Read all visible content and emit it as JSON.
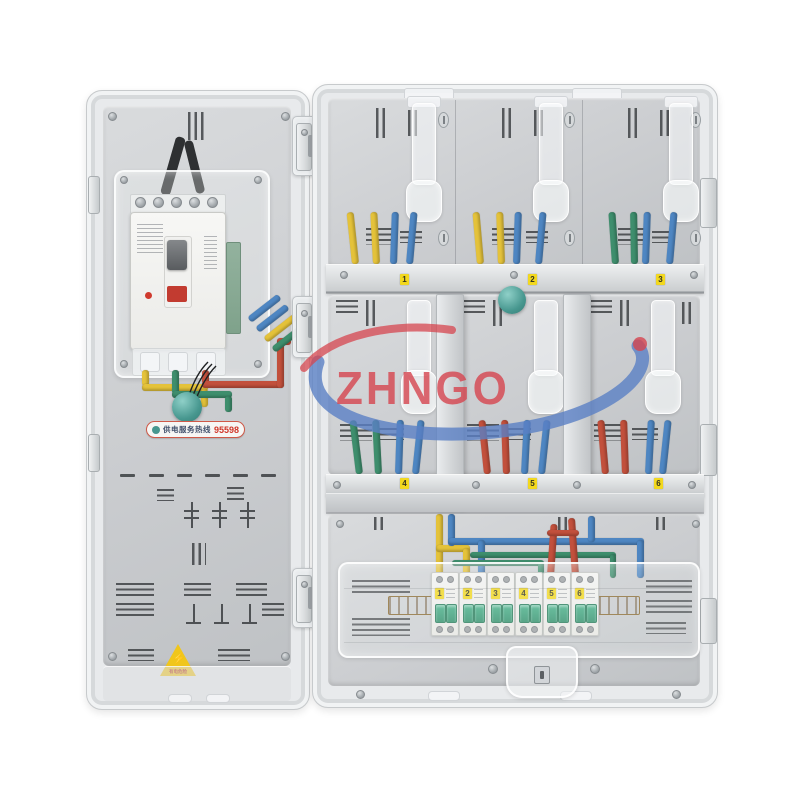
{
  "watermark": {
    "text": "ZHNGO"
  },
  "left_panel": {
    "hotline_label": {
      "prefix": "供电服务热线",
      "number": "95598"
    },
    "warning_sticker": {
      "bolt": "⚡",
      "text": "有电危险"
    }
  },
  "meter_rows": {
    "top_tags": [
      "1",
      "2",
      "3"
    ],
    "mid_tags": [
      "4",
      "5",
      "6"
    ]
  },
  "breakers": {
    "tags": [
      "1",
      "2",
      "3",
      "4",
      "5",
      "6"
    ]
  },
  "colors": {
    "wire_yellow": "#e4c23a",
    "wire_blue": "#4e86c2",
    "wire_green": "#3e8e6d",
    "wire_red": "#c2503c",
    "toggle_green": "#2f8f6a",
    "tag_yellow": "#f2d81e",
    "seal_teal": "#47978f",
    "slot_dark": "#3a3d40",
    "watermark_red": "#d6454f",
    "watermark_blue": "#5a7fc4"
  }
}
